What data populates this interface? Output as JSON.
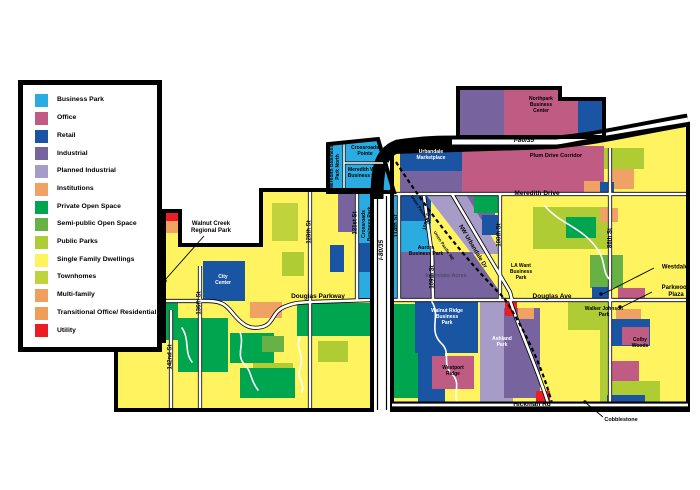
{
  "legend": {
    "items": [
      {
        "label": "Business Park",
        "color": "#2AACE2"
      },
      {
        "label": "Office",
        "color": "#C05C84"
      },
      {
        "label": "Retail",
        "color": "#1A55A3"
      },
      {
        "label": "Industrial",
        "color": "#77649F"
      },
      {
        "label": "Planned Industrial",
        "color": "#A79BC8"
      },
      {
        "label": "Institutions",
        "color": "#F0A164"
      },
      {
        "label": "Private Open Space",
        "color": "#00A550"
      },
      {
        "label": "Semi-public Open Space",
        "color": "#68B245"
      },
      {
        "label": "Public Parks",
        "color": "#B0CC34"
      },
      {
        "label": "Single Family Dwellings",
        "color": "#FFF35F"
      },
      {
        "label": "Townhomes",
        "color": "#C0D23C"
      },
      {
        "label": "Multi-family",
        "color": "#EFA05F"
      },
      {
        "label": "Transitional Office/ Residential",
        "color": "#EE9E58"
      },
      {
        "label": "Utility",
        "color": "#EC1C24"
      }
    ]
  },
  "map": {
    "highways": {
      "i80_35": "I-80/35"
    },
    "roads": {
      "meredith_drive": "Meredith Drive",
      "douglas_parkway": "Douglas Parkway",
      "douglas_ave": "Douglas Ave",
      "hickman_rd": "Hickman Rd",
      "street_142": "142nd St",
      "street_136": "136th St",
      "street_128": "128th St",
      "street_121": "121st St",
      "street_114": "114th St",
      "street_108": "108th St",
      "street_109": "109th St",
      "street_100": "100th St",
      "street_86": "86th St",
      "nw_urbandale": "NW Urbandale Dr"
    },
    "railroad": "Union Pacific RR",
    "areas": {
      "meredith_bp_north": "Meredith Business\nPark North",
      "crossroads_pointe": "Crossroads\nPointe",
      "meredith_west": "Meredith West\nBusiness Park",
      "crossroads_bp": "Crossroads\nBusiness Park",
      "urbandale_marketplace": "Urbandale\nMarketplace",
      "northpark": "Northpark\nBusiness\nCenter",
      "plum_drive": "Plum Drive Corridor",
      "aurora": "Aurora\nBusiness Park",
      "interstate_acres": "Interstate Acres",
      "city_center": "City\nCenter",
      "walnut_ridge": "Walnut Ridge\nBusiness\nPark",
      "westport_ridge": "Westport\nRidge",
      "ashland_park": "Ashland\nPark",
      "la_want": "LA Want\nBusiness\nPark",
      "walker_johnson": "Walker Johnson\nPark",
      "colby_woods": "Colby\nWoods"
    },
    "callouts": {
      "walnut_creek": "Walnut Creek\nRegional Park",
      "westdale": "Westdale",
      "parkwood": "Parkwood\nPlaza",
      "cobblestone": "Cobblestone"
    }
  }
}
